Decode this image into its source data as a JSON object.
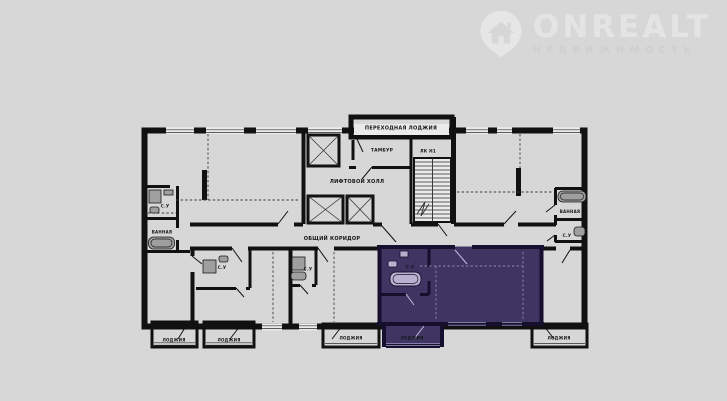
{
  "page": {
    "background_color": "#d7d7d7"
  },
  "logo": {
    "brand": "ONREALT",
    "subtitle": "НЕДВИЖИМОСТЬ",
    "brand_color": "#e4e4e4",
    "subtitle_color": "#cfcfcf"
  },
  "plan": {
    "colors": {
      "floor": "#ebebeb",
      "wall": "#111111",
      "highlight": "#3f3563",
      "highlight_wall": "#16102e",
      "highlight_text": "#c5c0de",
      "highlight_loggia_text": "#241d45",
      "highlight_window_line": "#8f88b5",
      "fixture": "#9f9f9f"
    },
    "labels": {
      "transition_loggia": "ПЕРЕХОДНАЯ ЛОДЖИЯ",
      "tambour": "ТАМБУР",
      "staircase": "ЛК Н1",
      "elevator_hall": "ЛИФТОВОЙ ХОЛЛ",
      "common_corridor": "ОБЩИЙ КОРИДОР",
      "wc": "С.У",
      "bathroom": "ВАННАЯ",
      "loggia": "ЛОДЖИЯ"
    }
  }
}
